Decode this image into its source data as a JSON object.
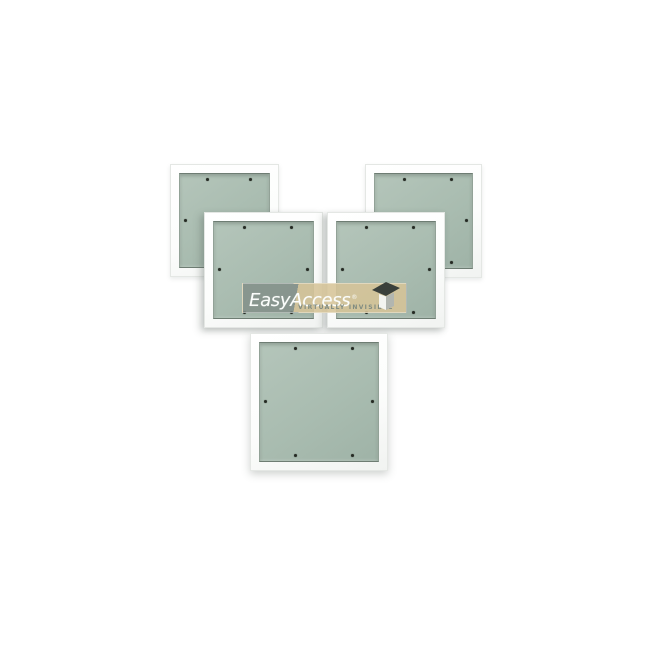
{
  "scene": {
    "description": "Five recessed access panels with green plasterboard inlay doors arranged in a pyramid collage on a white background, with EasyAccess watermark",
    "background_color": "#ffffff"
  },
  "colors": {
    "scene_bg": "#ffffff",
    "frame_border": "#e4e7e4",
    "board_green": "#a9bcb0",
    "board_green_light": "#b4c5ba",
    "board_green_dark": "#9fb3a7",
    "recess_line_dark": "#6e7d73",
    "recess_line_side": "#92a297",
    "screw_dark": "#262b24"
  },
  "panels": {
    "count": 5,
    "screws_per_panel": 6,
    "items": [
      {
        "id": "back-left",
        "left": 170,
        "top": 164,
        "width": 109,
        "height": 113,
        "layer": 1
      },
      {
        "id": "back-right",
        "left": 365,
        "top": 164,
        "width": 117,
        "height": 114,
        "layer": 1
      },
      {
        "id": "middle-left",
        "left": 204,
        "top": 212,
        "width": 119,
        "height": 116,
        "layer": 2
      },
      {
        "id": "middle-right",
        "left": 327,
        "top": 212,
        "width": 118,
        "height": 116,
        "layer": 2
      },
      {
        "id": "front-bottom",
        "left": 250,
        "top": 333,
        "width": 138,
        "height": 138,
        "layer": 3
      }
    ]
  },
  "watermark": {
    "brand_easy": "Easy",
    "brand_access": "Access",
    "registered": "®",
    "tagline": "VIRTUALLY INVISIBLE",
    "gray_band_color": "rgba(131,143,137,0.85)",
    "tan_band_color": "rgba(214,196,152,0.88)",
    "split_percent": 33,
    "text_color": "#fbfdfb",
    "tagline_color": "#7f8b81",
    "icon": "open-lid-box-icon",
    "icon_lid_color": "#3a403b",
    "icon_front_color": "#f3f4f0",
    "icon_side_color": "#b2b6b0",
    "left": 242,
    "top": 283,
    "width": 165,
    "height": 30
  }
}
